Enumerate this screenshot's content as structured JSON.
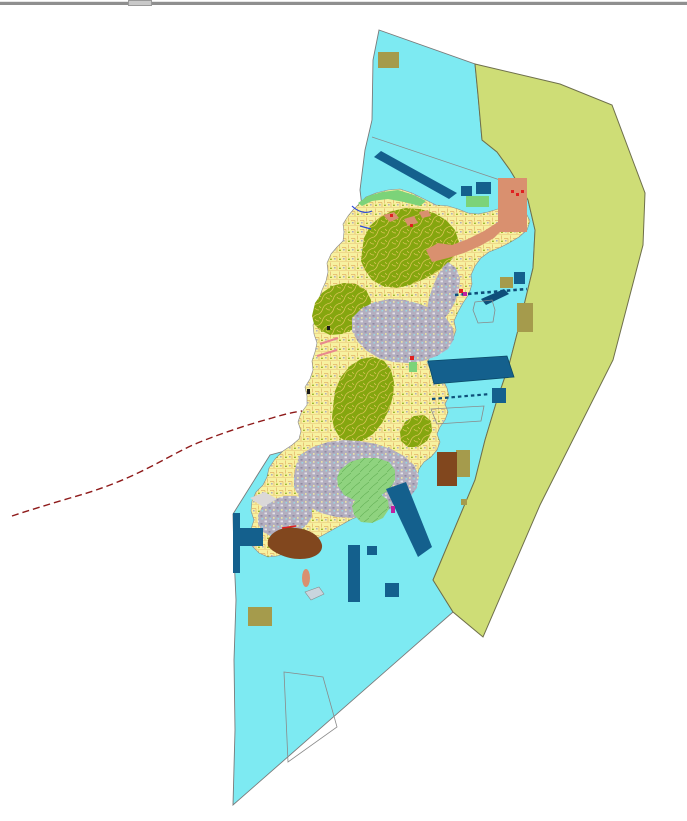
{
  "window": {
    "top_bar": {
      "kind": "horizontal-resize-divider",
      "has_handle_notch": true
    }
  },
  "map": {
    "type": "gis-land-use-map",
    "colors": {
      "background": "#FFFFFF",
      "topbar": "#8F8F8F",
      "topbar_notch": "#C9C9C9",
      "sea": "#7DEAF2",
      "sea_border": "#7A7A7A",
      "buffer": "#CEDD76",
      "buffer_border": "#6E6F4B",
      "island_base": "#F7F1A0",
      "parcel_line": "#E2B266",
      "coast_line": "#8A8A8A",
      "forest": "#85A60F",
      "forest_line": "#D8C455",
      "urban": "#B3AEBF",
      "urban_speck": "#FFFFFF",
      "urban_dark": "#8F89A3",
      "water_speck": "#8FE2EE",
      "greenspace": "#8FD37F",
      "green_line": "#69B55B",
      "bright_green": "#7CD379",
      "salmon": "#D9906F",
      "dark_blue": "#14608D",
      "dark_blue_edge": "#0A4A68",
      "navy": "#0E4F7A",
      "brown": "#81471E",
      "khaki": "#A59B4C",
      "red": "#E02020",
      "magenta": "#C020A0",
      "pink": "#E8888E",
      "red_dash": "#8E1A1A",
      "river": "#2B49D8",
      "islet_gray": "#C9D5DE",
      "light_gray": "#DBD8D8",
      "black": "#1A1A1A",
      "zone_outline": "#8A8A8A"
    },
    "zones": [
      {
        "name": "sea",
        "color_key": "sea"
      },
      {
        "name": "coastal-buffer-zone",
        "color_key": "buffer"
      },
      {
        "name": "island-landmass-parcels",
        "color_key": "island_base"
      },
      {
        "name": "forest-land",
        "color_key": "forest"
      },
      {
        "name": "urban-built-up",
        "color_key": "urban"
      },
      {
        "name": "green-open-space",
        "color_key": "greenspace"
      },
      {
        "name": "port-district",
        "color_key": "salmon"
      },
      {
        "name": "harbor-structures",
        "color_key": "dark_blue"
      },
      {
        "name": "industrial-block",
        "color_key": "brown"
      },
      {
        "name": "facility-block",
        "color_key": "khaki"
      }
    ],
    "annotations": [
      {
        "name": "western-boundary-route",
        "style": "dashed",
        "color_key": "red_dash"
      },
      {
        "name": "marine-zone-outlines",
        "style": "thin-outline",
        "color_key": "zone_outline"
      },
      {
        "name": "mooring-chains",
        "style": "dashed-thick",
        "color_key": "navy"
      }
    ]
  }
}
